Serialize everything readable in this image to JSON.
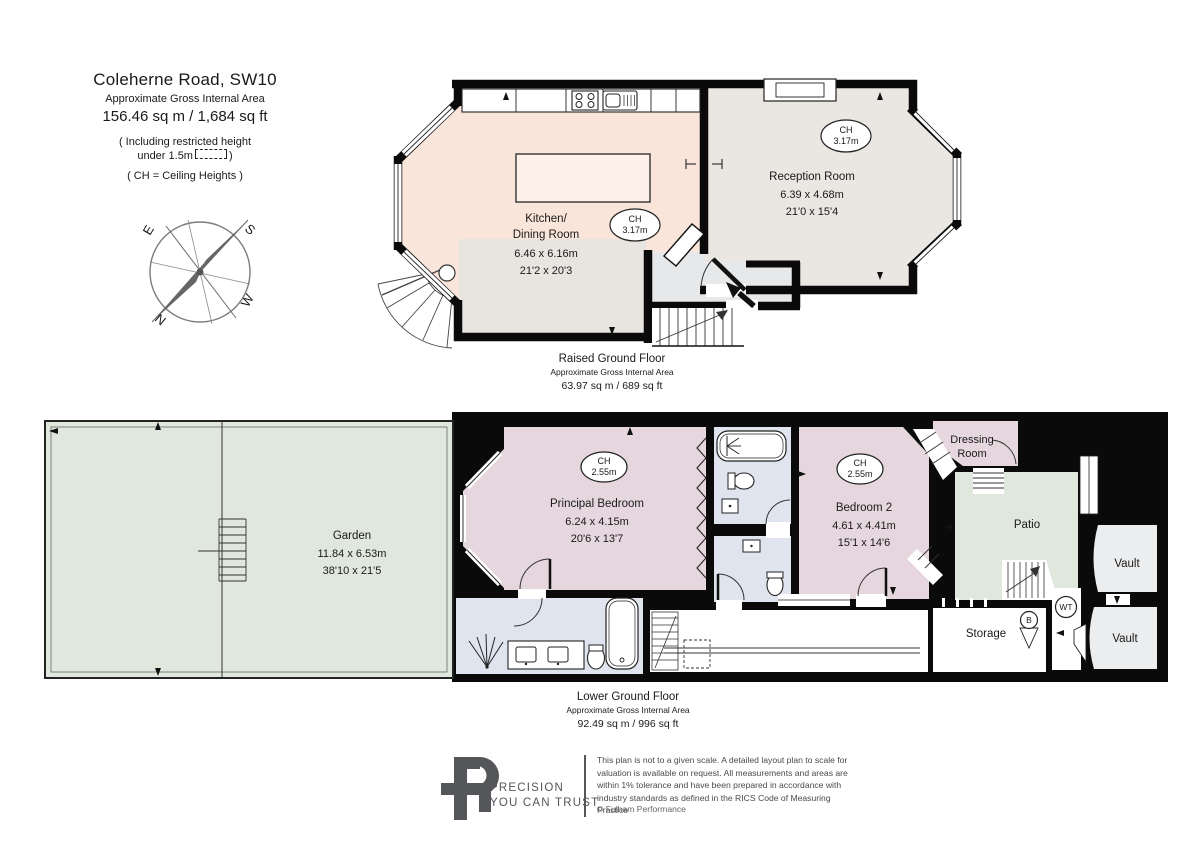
{
  "title_block": {
    "address": "Coleherne Road, SW10",
    "gia_label": "Approximate Gross Internal Area",
    "gia_value": "156.46 sq m  /  1,684 sq ft",
    "restricted_note_prefix": "( Including restricted height",
    "restricted_note_line2": "under 1.5m",
    "restricted_note_suffix": ")",
    "ch_note": "( CH = Ceiling Heights )"
  },
  "compass": {
    "north": "N",
    "south": "S",
    "east": "E",
    "west": "W"
  },
  "floors": {
    "raised_ground": {
      "caption_title": "Raised Ground Floor",
      "caption_subtitle": "Approximate Gross Internal Area",
      "caption_area": "63.97 sq m  /  689 sq ft",
      "kitchen": {
        "name_line1": "Kitchen/",
        "name_line2": "Dining Room",
        "size_metric": "6.46 x 6.16m",
        "size_imperial": "21'2 x 20'3",
        "ch_label": "CH",
        "ch_value": "3.17m"
      },
      "reception": {
        "name": "Reception Room",
        "size_metric": "6.39 x 4.68m",
        "size_imperial": "21'0 x 15'4",
        "ch_label": "CH",
        "ch_value": "3.17m"
      }
    },
    "lower_ground": {
      "caption_title": "Lower Ground Floor",
      "caption_subtitle": "Approximate Gross Internal Area",
      "caption_area": "92.49 sq m  /  996 sq ft",
      "garden": {
        "name": "Garden",
        "size_metric": "11.84 x 6.53m",
        "size_imperial": "38'10 x 21'5"
      },
      "principal_bedroom": {
        "name": "Principal Bedroom",
        "size_metric": "6.24 x 4.15m",
        "size_imperial": "20'6 x 13'7",
        "ch_label": "CH",
        "ch_value": "2.55m"
      },
      "bedroom2": {
        "name": "Bedroom 2",
        "size_metric": "4.61 x 4.41m",
        "size_imperial": "15'1 x 14'6",
        "ch_label": "CH",
        "ch_value": "2.55m"
      },
      "dressing_room": {
        "name_line1": "Dressing",
        "name_line2": "Room"
      },
      "patio": {
        "name": "Patio"
      },
      "vault_upper": {
        "name": "Vault"
      },
      "vault_lower": {
        "name": "Vault"
      },
      "storage": {
        "name": "Storage"
      },
      "boiler_label": "B",
      "water_tank_label": "WT"
    }
  },
  "footer": {
    "brand_line1": "PRECISION",
    "brand_line2": "YOU CAN TRUST",
    "disclaimer": "This plan is not to a given scale. A detailed layout plan to scale for valuation is available on request. All measurements and areas are within 1% tolerance and have been prepared in accordance with industry standards as defined in the RICS Code of Measuring Practice",
    "copyright": "© Fulham Performance"
  },
  "colors": {
    "kitchen": "#fae5da",
    "dining": "#e8e4df",
    "reception": "#eae6e1",
    "hallway": "#e7e8ea",
    "bedroom": "#e6d6de",
    "bathroom": "#dfe4ee",
    "garden": "#e0e7dd",
    "vault": "#ecedee",
    "wall": "#0a0a0a",
    "brand": "#54565a"
  }
}
